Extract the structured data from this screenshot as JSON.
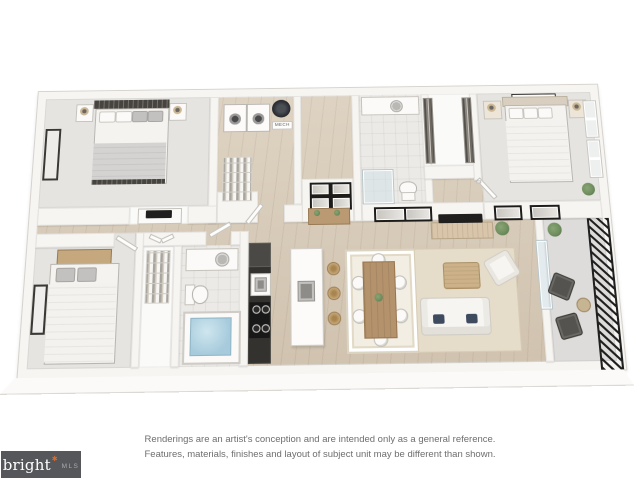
{
  "disclaimer": {
    "line1": "Renderings are an artist's conception and are intended only as a general reference.",
    "line2": "Features, materials, finishes and layout of subject unit may be different than shown."
  },
  "logo": {
    "brand": "bright",
    "suffix": "MLS"
  },
  "plan": {
    "mech_label": "MECH"
  },
  "palette": {
    "wood": "#d7c9b5",
    "carpet": "#e5e4e1",
    "tile": "#eceae6",
    "concrete": "#dddcda",
    "wall": "#f7f5f2",
    "wall_edge": "#d6d3ce",
    "dark": "#34322f",
    "wood_furn": "#b4926c",
    "water": "#a7cbdc",
    "rug_cream": "#f2eee3",
    "rug_beige": "#e5dcc9",
    "green": "#6d8c5c",
    "railing": "#1f1f1f",
    "logo_bg": "#56575a",
    "logo_star": "#d96c2f",
    "logo_mls": "#a9aaac",
    "text": "#6e6e6e"
  }
}
